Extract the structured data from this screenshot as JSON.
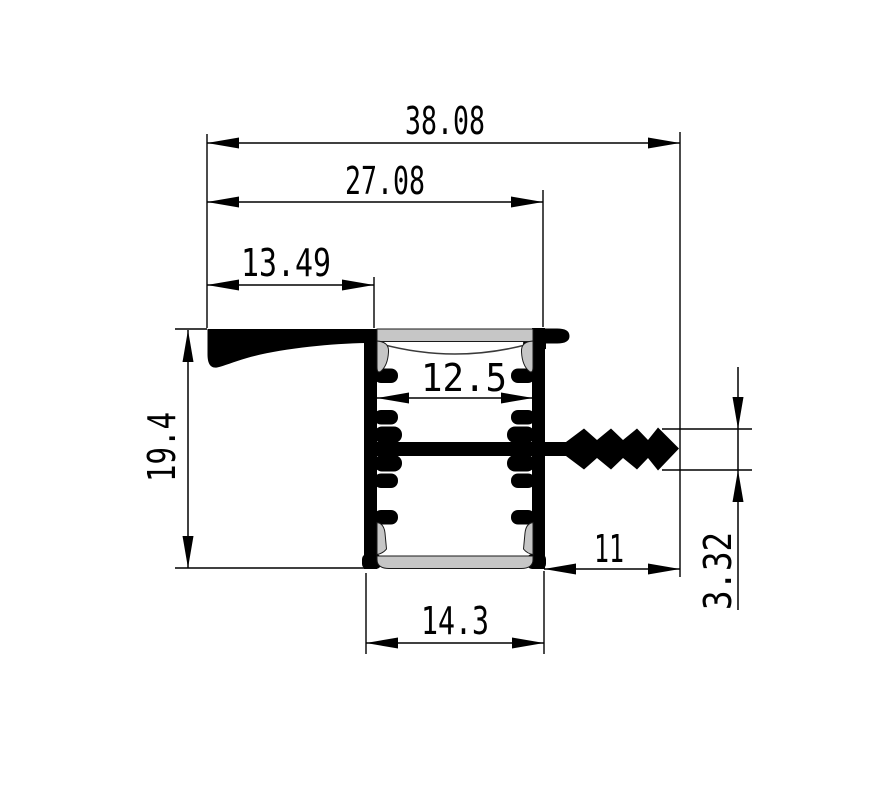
{
  "drawing": {
    "type": "technical_cross_section",
    "subject": "Aluminium LED strip mounting profile - dimensioned cross-section",
    "units": "mm",
    "background_color": "#ffffff",
    "colors": {
      "lines_and_metal": "#000000",
      "diffuser": "#c6c6c6"
    },
    "dimensions": {
      "overall_width": {
        "label": "38.08",
        "value": 38.08,
        "orientation": "horizontal",
        "measures": "left flange edge to anchor fin tip"
      },
      "flange_to_body_right": {
        "label": "27.08",
        "value": 27.08,
        "orientation": "horizontal",
        "measures": "left flange edge to body right wall"
      },
      "flange_width": {
        "label": "13.49",
        "value": 13.49,
        "orientation": "horizontal",
        "measures": "left flange edge to body left wall"
      },
      "chamber_inner_width": {
        "label": "12.5",
        "value": 12.5,
        "orientation": "horizontal",
        "measures": "inner width of LED chamber"
      },
      "overall_height": {
        "label": "19.4",
        "value": 19.4,
        "orientation": "vertical",
        "measures": "overall profile height"
      },
      "body_width": {
        "label": "14.3",
        "value": 14.3,
        "orientation": "horizontal",
        "measures": "outer width of main body"
      },
      "fin_length": {
        "label": "11",
        "value": 11,
        "orientation": "horizontal",
        "measures": "barbed anchor fin length"
      },
      "fin_height": {
        "label": "3.32",
        "value": 3.32,
        "orientation": "vertical",
        "measures": "barbed anchor fin height"
      }
    }
  }
}
